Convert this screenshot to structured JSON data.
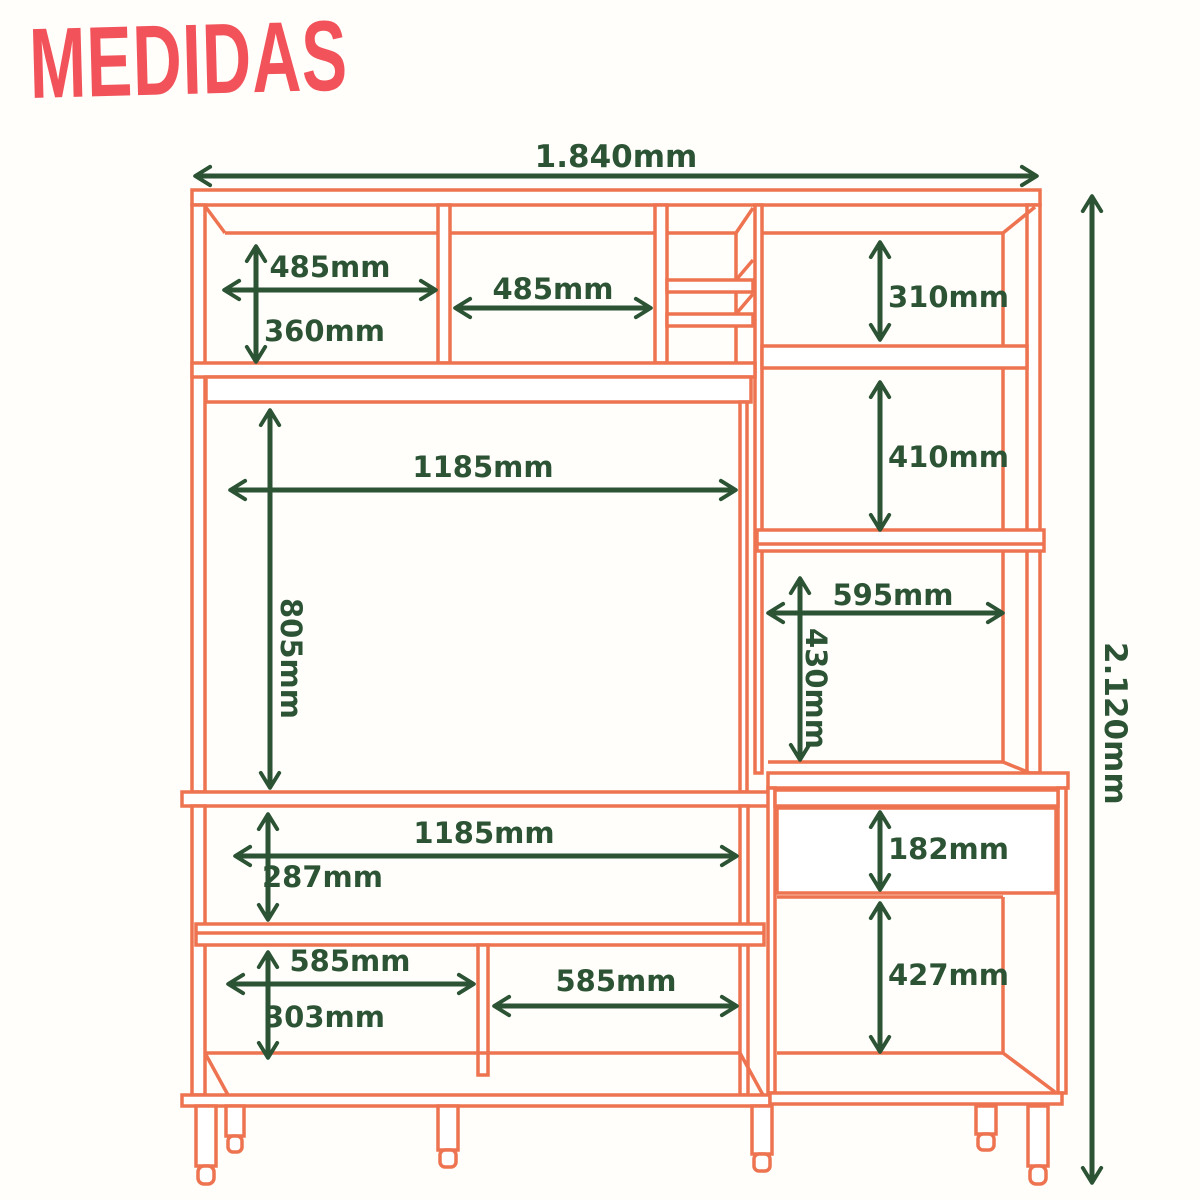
{
  "title": "MEDIDAS",
  "colors": {
    "accent_red": "#f2535a",
    "furniture_line_orange": "#ee7350",
    "dimension_green": "#2b5334",
    "background": "#fffefb"
  },
  "dimensions": {
    "overall_width": "1.840mm",
    "overall_height": "2.120mm",
    "top_left_compartment_width": "485mm",
    "top_left_compartment_height": "360mm",
    "top_center_compartment_width": "485mm",
    "top_right_compartment_height": "310mm",
    "right_shelf_compartment_height": "410mm",
    "tv_space_width": "1185mm",
    "tv_space_height": "805mm",
    "right_lower_compartment_width": "595mm",
    "right_lower_compartment_height": "430mm",
    "base_shelf_width": "1185mm",
    "base_shelf_height": "287mm",
    "drawer_height": "182mm",
    "base_right_compartment_height": "427mm",
    "base_left_compartment_width": "585mm",
    "base_left_compartment_height": "303mm",
    "base_center_compartment_width": "585mm"
  }
}
